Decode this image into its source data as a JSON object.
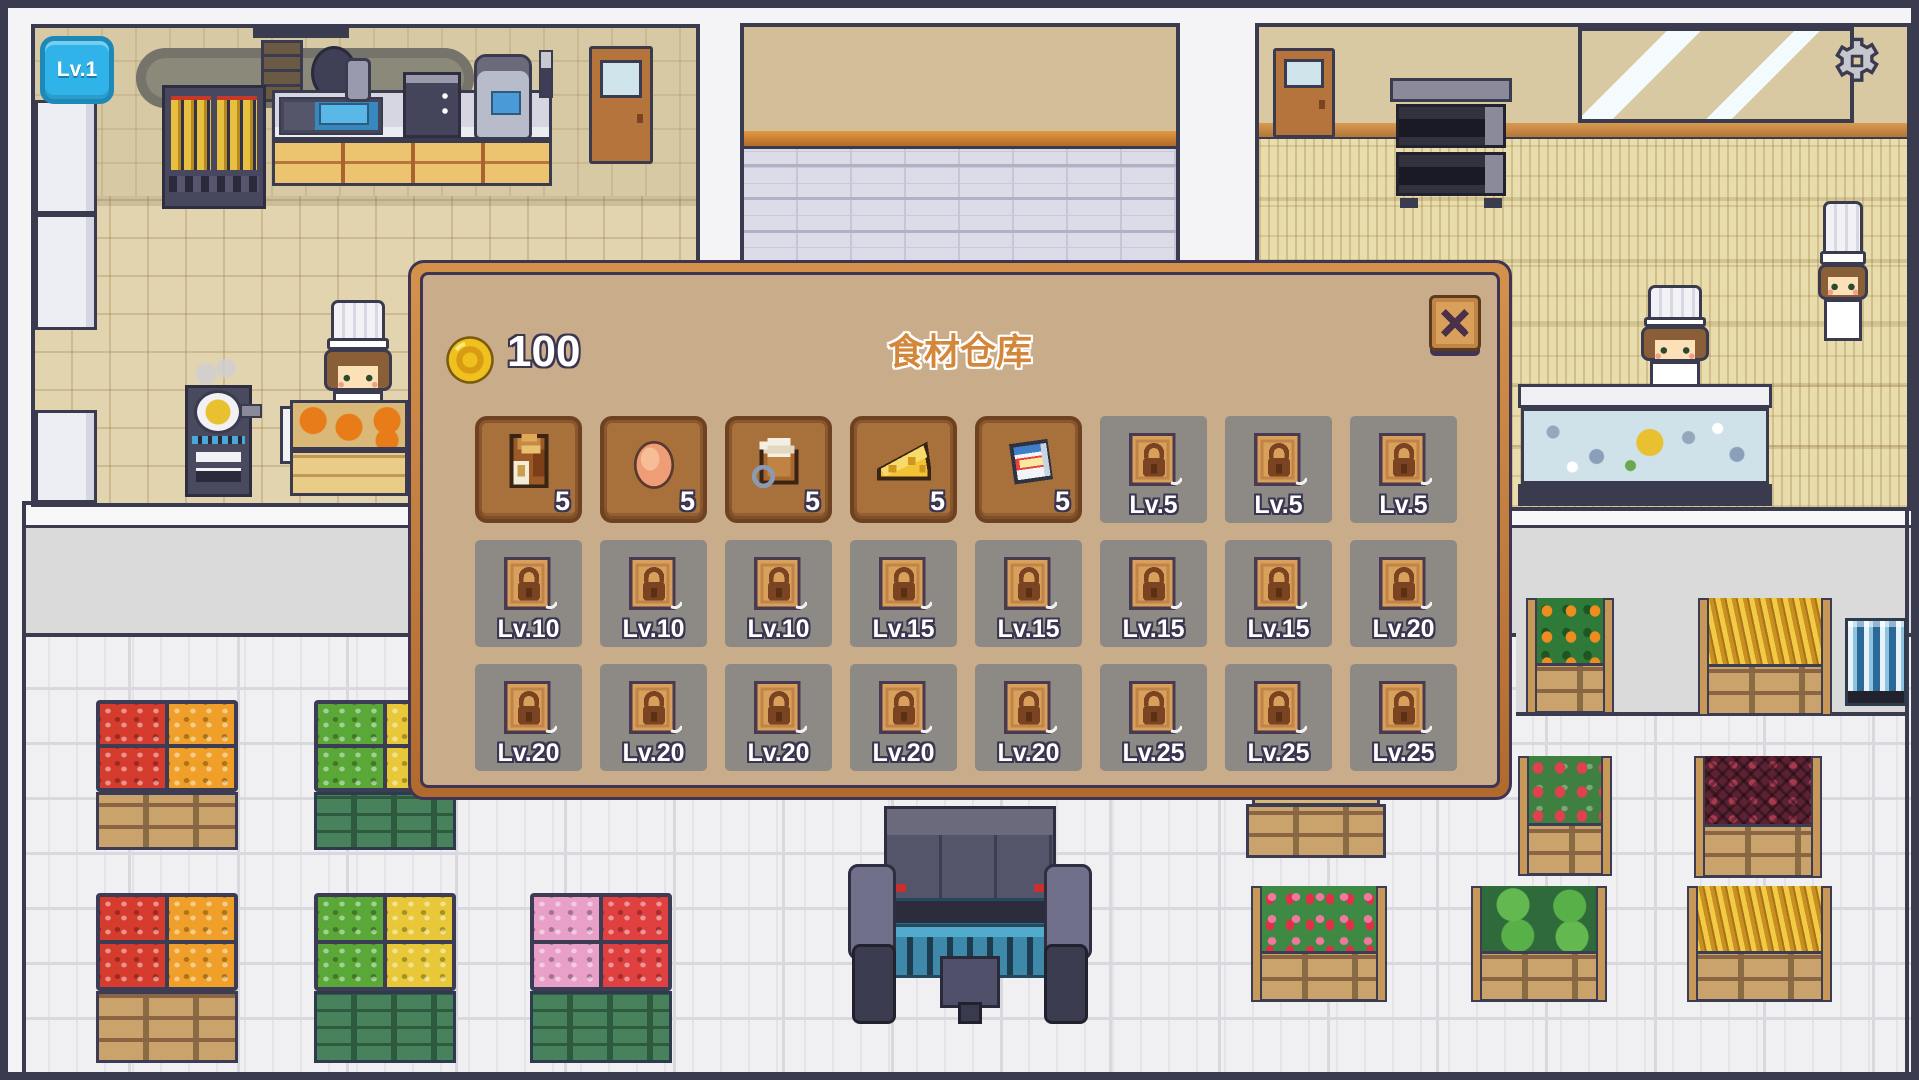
{
  "hud": {
    "level_badge": "Lv.1",
    "settings_icon": "gear"
  },
  "modal": {
    "title": "食材仓库",
    "coin_icon": "gold-coin",
    "coin_count": "100",
    "close_icon": "pixel-x",
    "slots": [
      {
        "state": "unlocked",
        "icon": "flour-bag",
        "count": "5"
      },
      {
        "state": "unlocked",
        "icon": "egg",
        "count": "5"
      },
      {
        "state": "unlocked",
        "icon": "cream-bag",
        "count": "5"
      },
      {
        "state": "unlocked",
        "icon": "cheese",
        "count": "5"
      },
      {
        "state": "unlocked",
        "icon": "milk-carton",
        "count": "5"
      },
      {
        "state": "locked",
        "icon": "padlock",
        "label": "Lv.5"
      },
      {
        "state": "locked",
        "icon": "padlock",
        "label": "Lv.5"
      },
      {
        "state": "locked",
        "icon": "padlock",
        "label": "Lv.5"
      },
      {
        "state": "locked",
        "icon": "padlock",
        "label": "Lv.10"
      },
      {
        "state": "locked",
        "icon": "padlock",
        "label": "Lv.10"
      },
      {
        "state": "locked",
        "icon": "padlock",
        "label": "Lv.10"
      },
      {
        "state": "locked",
        "icon": "padlock",
        "label": "Lv.15"
      },
      {
        "state": "locked",
        "icon": "padlock",
        "label": "Lv.15"
      },
      {
        "state": "locked",
        "icon": "padlock",
        "label": "Lv.15"
      },
      {
        "state": "locked",
        "icon": "padlock",
        "label": "Lv.15"
      },
      {
        "state": "locked",
        "icon": "padlock",
        "label": "Lv.20"
      },
      {
        "state": "locked",
        "icon": "padlock",
        "label": "Lv.20"
      },
      {
        "state": "locked",
        "icon": "padlock",
        "label": "Lv.20"
      },
      {
        "state": "locked",
        "icon": "padlock",
        "label": "Lv.20"
      },
      {
        "state": "locked",
        "icon": "padlock",
        "label": "Lv.20"
      },
      {
        "state": "locked",
        "icon": "padlock",
        "label": "Lv.20"
      },
      {
        "state": "locked",
        "icon": "padlock",
        "label": "Lv.25"
      },
      {
        "state": "locked",
        "icon": "padlock",
        "label": "Lv.25"
      },
      {
        "state": "locked",
        "icon": "padlock",
        "label": "Lv.25"
      }
    ]
  },
  "colors": {
    "frame_orange": "#b06a2e",
    "panel_tan": "#c9ac8a",
    "slot_brown": "#a8713c",
    "locked_gray": "#8d8a86",
    "badge_blue": "#2fb3e8",
    "title_orange": "#d3873a",
    "coin_gold": "#f0c11e"
  }
}
